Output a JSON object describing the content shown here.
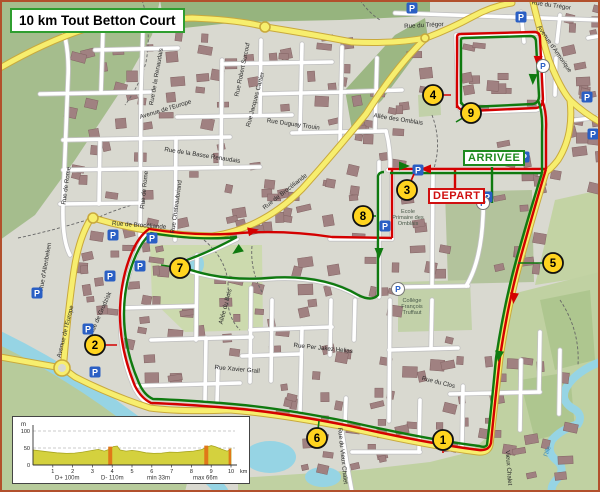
{
  "title": "10 km Tout Betton Court",
  "finish_label": "ARRIVEE",
  "start_label": "DEPART",
  "parking_label": "P",
  "colors": {
    "route_red": "#d40000",
    "route_green": "#0f7a0f",
    "waypoint_fill": "#ffd41f",
    "parking_blue": "#2a5fc4",
    "title_border": "#2f9e2f",
    "finish_green": "#1e8a1e",
    "start_red": "#d01010",
    "road_yellow": "#f7ee6e",
    "water": "#96d4e4",
    "forest": "#a5bd8d",
    "profile_fill": "#d4d13e",
    "steep_fill": "#e07818"
  },
  "waypoints": [
    {
      "n": "1",
      "x": 443,
      "y": 440,
      "tx": 443,
      "ty": 453,
      "c": "red"
    },
    {
      "n": "2",
      "x": 95,
      "y": 345,
      "tx": 117,
      "ty": 345,
      "c": "red"
    },
    {
      "n": "3",
      "x": 407,
      "y": 190,
      "tx": 414,
      "ty": 174,
      "c": "red"
    },
    {
      "n": "4",
      "x": 433,
      "y": 95,
      "tx": 451,
      "ty": 95,
      "c": "red"
    },
    {
      "n": "5",
      "x": 553,
      "y": 263,
      "tx": 518,
      "ty": 263,
      "c": "green"
    },
    {
      "n": "6",
      "x": 317,
      "y": 438,
      "tx": 319,
      "ty": 421,
      "c": "green"
    },
    {
      "n": "7",
      "x": 180,
      "y": 268,
      "tx": 161,
      "ty": 265,
      "c": "green"
    },
    {
      "n": "8",
      "x": 363,
      "y": 216,
      "tx": 376,
      "ty": 216,
      "c": "green"
    },
    {
      "n": "9",
      "x": 471,
      "y": 113,
      "tx": 456,
      "ty": 122,
      "c": "green"
    }
  ],
  "parkings": {
    "squares": [
      [
        412,
        8
      ],
      [
        521,
        17
      ],
      [
        587,
        97
      ],
      [
        593,
        134
      ],
      [
        418,
        170
      ],
      [
        524,
        157
      ],
      [
        487,
        197
      ],
      [
        385,
        226
      ],
      [
        113,
        235
      ],
      [
        152,
        238
      ],
      [
        140,
        266
      ],
      [
        110,
        276
      ],
      [
        37,
        293
      ],
      [
        88,
        329
      ],
      [
        95,
        372
      ]
    ],
    "circles": [
      [
        398,
        289
      ],
      [
        483,
        203
      ],
      [
        543,
        66
      ]
    ]
  },
  "street_labels": [
    {
      "t": "Rue du Trégor",
      "x": 424,
      "y": 27,
      "r": -3
    },
    {
      "t": "Rue du Trégor",
      "x": 551,
      "y": 7,
      "r": 8
    },
    {
      "t": "Avenue d'Armorique",
      "x": 553,
      "y": 50,
      "r": 55
    },
    {
      "t": "Allée des Omblais",
      "x": 398,
      "y": 121,
      "r": 9
    },
    {
      "t": "Avenue de l'Europe",
      "x": 166,
      "y": 111,
      "r": -17
    },
    {
      "t": "Avenue de l'Europe",
      "x": 67,
      "y": 332,
      "r": -76
    },
    {
      "t": "Rue de Rome",
      "x": 68,
      "y": 186,
      "r": -82
    },
    {
      "t": "Rue de Rome",
      "x": 146,
      "y": 190,
      "r": -84
    },
    {
      "t": "Rue de la Basse Renaudais",
      "x": 202,
      "y": 157,
      "r": 9
    },
    {
      "t": "Rue Chateaubriand",
      "x": 178,
      "y": 207,
      "r": -82
    },
    {
      "t": "Rue Robert Surcouf",
      "x": 244,
      "y": 70,
      "r": -78
    },
    {
      "t": "Rue Jacques Cartier",
      "x": 257,
      "y": 100,
      "r": -75
    },
    {
      "t": "Rue Duguay Trouin",
      "x": 293,
      "y": 126,
      "r": 8
    },
    {
      "t": "Rue de Brocéliande",
      "x": 139,
      "y": 227,
      "r": 4
    },
    {
      "t": "Rue de Brocéliande",
      "x": 286,
      "y": 193,
      "r": -38
    },
    {
      "t": "Rue de Grodzisk",
      "x": 102,
      "y": 314,
      "r": -66
    },
    {
      "t": "Rue d'Altenbeken",
      "x": 47,
      "y": 267,
      "r": -80
    },
    {
      "t": "Allée du Bois",
      "x": 227,
      "y": 307,
      "r": -75
    },
    {
      "t": "Rue Xavier Grall",
      "x": 237,
      "y": 371,
      "r": 5
    },
    {
      "t": "Rue Per Jakez Helias",
      "x": 323,
      "y": 350,
      "r": 6
    },
    {
      "t": "Rue du Clos",
      "x": 438,
      "y": 384,
      "r": 14
    },
    {
      "t": "Rue du Vieux Chalet",
      "x": 341,
      "y": 456,
      "r": 84
    },
    {
      "t": "Vieux Chalet",
      "x": 507,
      "y": 468,
      "r": 86
    },
    {
      "t": "Rue de la Renaudais",
      "x": 158,
      "y": 77,
      "r": -80
    },
    {
      "t": "l'Ille",
      "x": 549,
      "y": 452,
      "r": -70
    }
  ],
  "poi_labels": [
    {
      "lines": [
        "Ecole",
        "Primaire des",
        "Omblais"
      ],
      "x": 408,
      "y": 213
    },
    {
      "lines": [
        "Collège",
        "François",
        "Truffaut"
      ],
      "x": 412,
      "y": 302
    }
  ],
  "route_arrows": {
    "red": [
      [
        427,
        169,
        180
      ],
      [
        538,
        60,
        92
      ],
      [
        514,
        297,
        96
      ],
      [
        252,
        231,
        -12
      ]
    ],
    "green": [
      [
        403,
        166,
        0
      ],
      [
        533,
        78,
        92
      ],
      [
        499,
        355,
        98
      ],
      [
        238,
        250,
        145
      ],
      [
        379,
        252,
        90
      ]
    ]
  },
  "chart_data": {
    "type": "area",
    "title": "",
    "xlabel": "km",
    "ylabel": "m",
    "xlim": [
      0,
      10
    ],
    "ylim": [
      0,
      115
    ],
    "x_ticks": [
      1,
      2,
      3,
      4,
      5,
      6,
      7,
      8,
      9,
      10
    ],
    "y_ticks": [
      0,
      50,
      100
    ],
    "grid": true,
    "profile": [
      [
        0,
        44
      ],
      [
        0.3,
        42
      ],
      [
        0.7,
        39
      ],
      [
        1.2,
        36
      ],
      [
        1.7,
        34
      ],
      [
        2.1,
        35
      ],
      [
        2.5,
        38
      ],
      [
        3,
        43
      ],
      [
        3.3,
        46
      ],
      [
        3.6,
        41
      ],
      [
        3.9,
        47
      ],
      [
        4.05,
        54
      ],
      [
        4.25,
        56
      ],
      [
        4.4,
        44
      ],
      [
        4.7,
        41
      ],
      [
        5,
        43
      ],
      [
        5.3,
        41
      ],
      [
        5.7,
        36
      ],
      [
        6.1,
        34
      ],
      [
        6.5,
        35
      ],
      [
        6.9,
        38
      ],
      [
        7.3,
        37
      ],
      [
        7.7,
        39
      ],
      [
        8.1,
        41
      ],
      [
        8.5,
        45
      ],
      [
        8.8,
        53
      ],
      [
        9,
        57
      ],
      [
        9.2,
        54
      ],
      [
        9.5,
        47
      ],
      [
        9.8,
        41
      ],
      [
        9.95,
        44
      ],
      [
        10,
        48
      ]
    ],
    "steep_bands_km": [
      [
        3.8,
        4.0,
        54
      ],
      [
        8.65,
        8.85,
        57
      ],
      [
        9.88,
        10,
        48
      ]
    ],
    "stats": [
      "D+ 100m",
      "D- 110m",
      "min 33m",
      "max 66m"
    ],
    "unit_label": "m",
    "km_suffix": "km"
  }
}
